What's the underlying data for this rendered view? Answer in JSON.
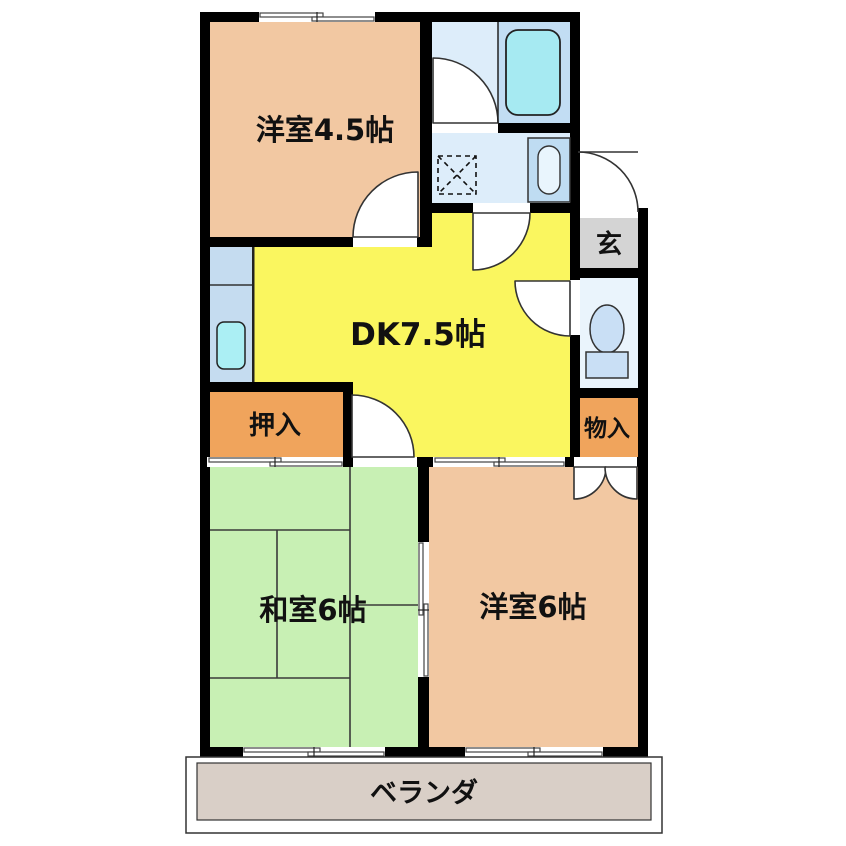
{
  "plan": {
    "type": "apartment-floor-plan",
    "rooms": {
      "yoshitsu45": {
        "label": "洋室4.5帖"
      },
      "dk": {
        "label": "DK7.5帖"
      },
      "washitsu6": {
        "label": "和室6帖"
      },
      "yoshitsu6": {
        "label": "洋室6帖"
      },
      "oshiire": {
        "label": "押入"
      },
      "monoire": {
        "label": "物入"
      },
      "genkan": {
        "label": "玄"
      },
      "veranda": {
        "label": "ベランダ"
      }
    },
    "fixtures": [
      "bathtub",
      "washbasin",
      "washing-machine-pan",
      "toilet",
      "kitchen-sink"
    ]
  },
  "colors": {
    "wall": "#000000",
    "salmon": "#F2C8A2",
    "dk_yellow": "#FAF65F",
    "tatami_green": "#C8F0B4",
    "closet_orange": "#F0A45C",
    "genkan_gray": "#D4D4D4",
    "veranda_tan": "#D9CFC7",
    "bath_floor": "#DDEDFA",
    "tub_zone": "#C2DDF3",
    "tub": "#A6EAF2",
    "toilet_floor": "#EAF4FC",
    "fixture_blue": "#C9DFF5",
    "kitchen": "#C5DCF0",
    "kitchen_sink": "#ABEFF4",
    "sink_cabinet": "#BFDCF2",
    "basin": "#E9F5FD"
  }
}
